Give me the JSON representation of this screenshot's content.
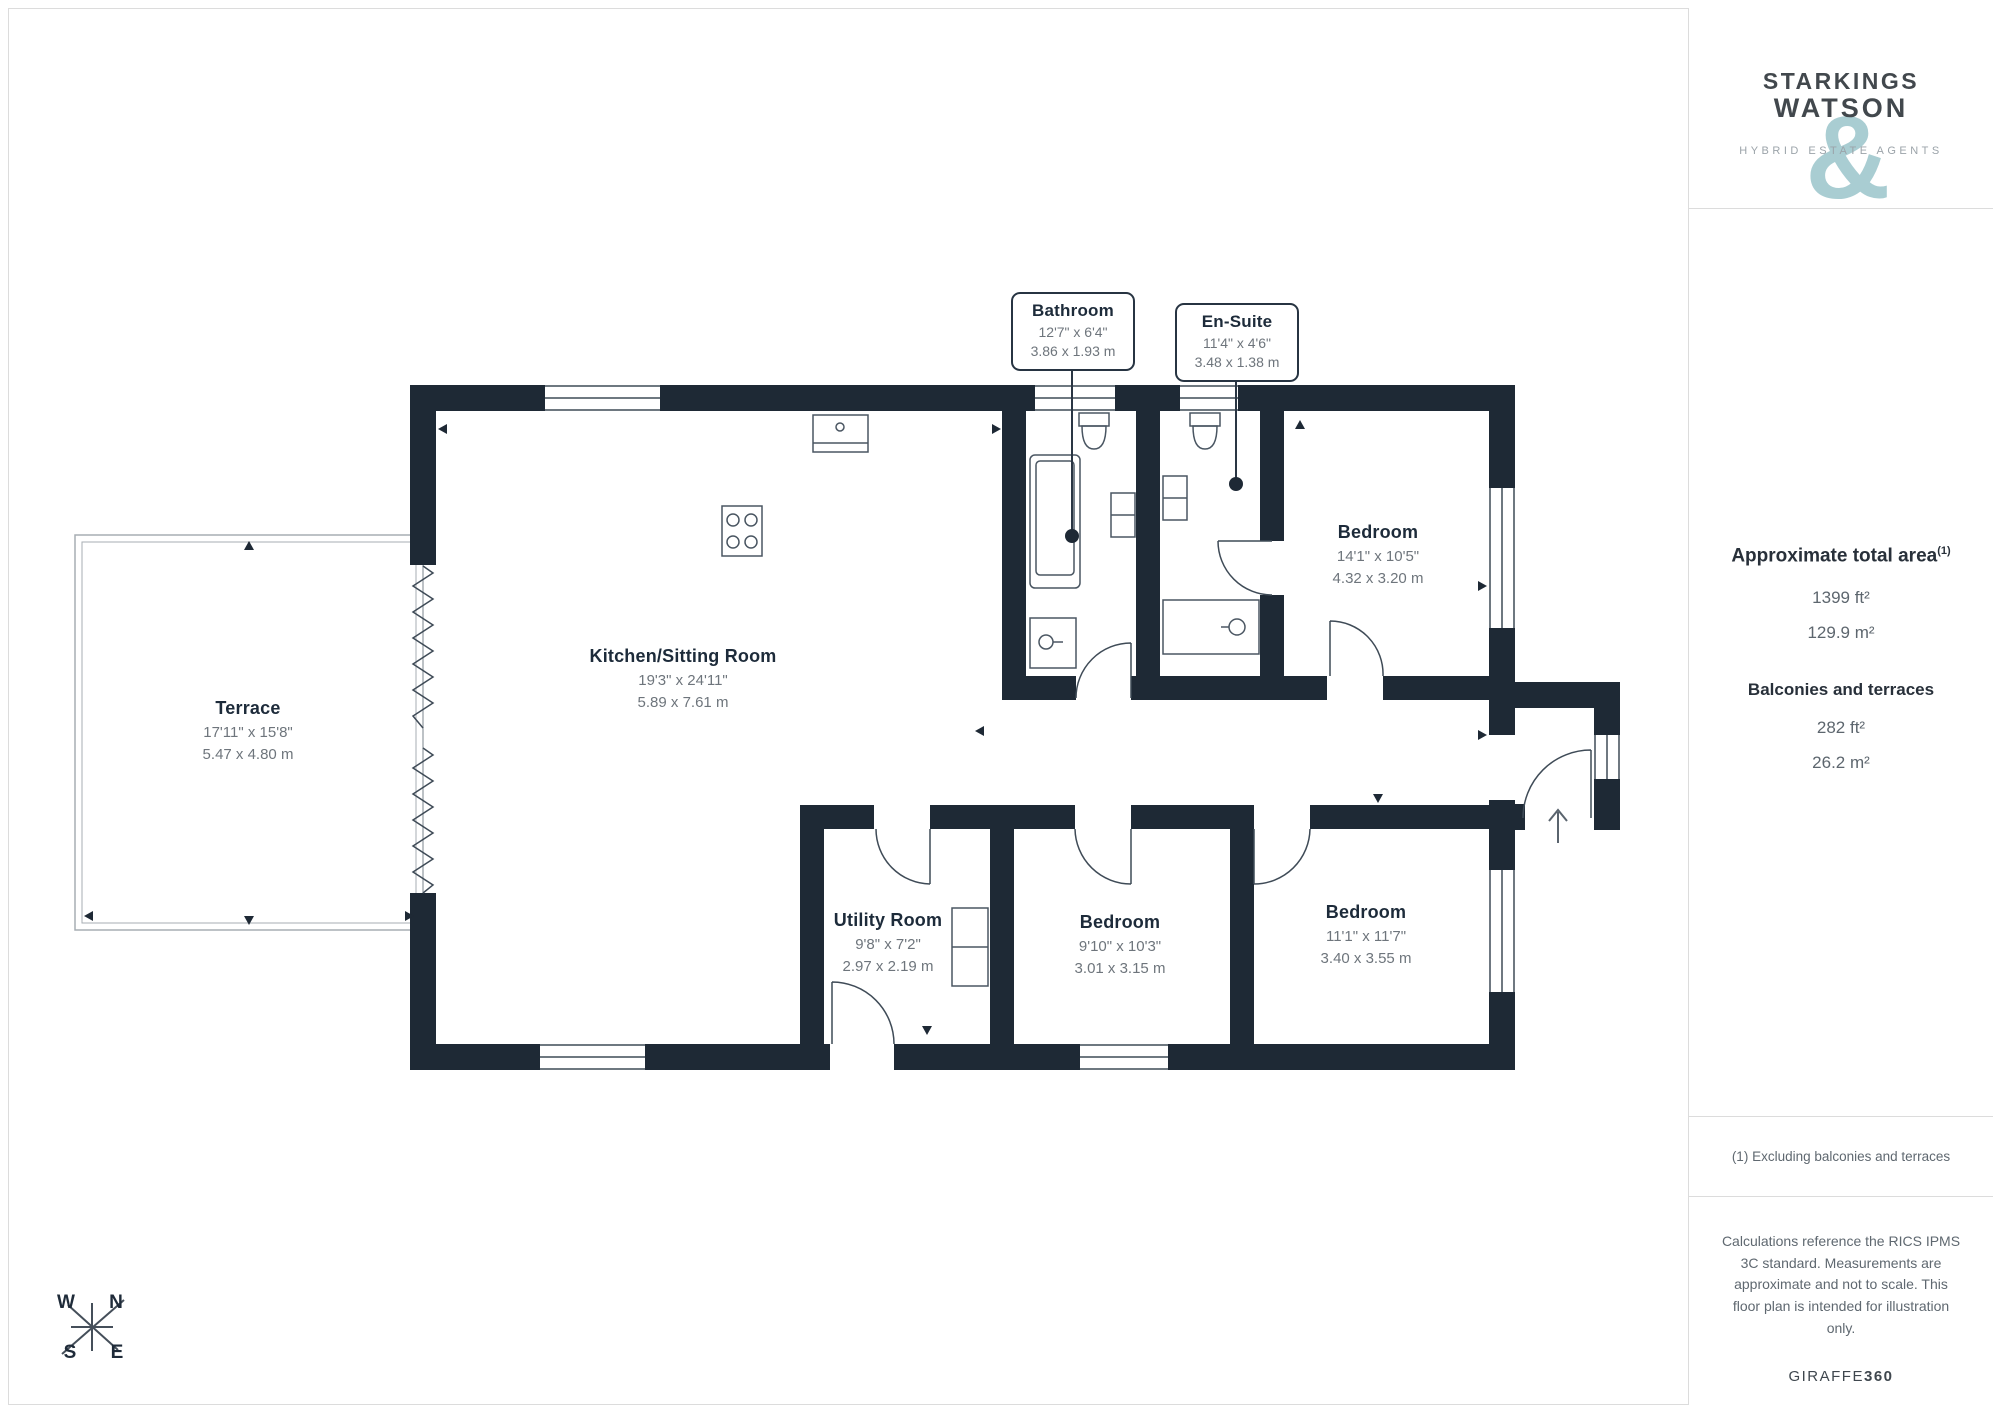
{
  "branding": {
    "name_line1": "STARKINGS",
    "name_line2": "WATSON",
    "ampersand": "&",
    "tagline": "HYBRID ESTATE AGENTS"
  },
  "sidebar": {
    "total_area_heading": "Approximate total area",
    "total_area_footnote": "(1)",
    "total_area_ft": "1399 ft²",
    "total_area_m": "129.9 m²",
    "balconies_heading": "Balconies and terraces",
    "balconies_ft": "282 ft²",
    "balconies_m": "26.2 m²",
    "footnote": "(1) Excluding balconies and terraces",
    "disclaimer": "Calculations reference the RICS IPMS 3C standard. Measurements are approximate and not to scale. This floor plan is intended for illustration only.",
    "brand_name": "GIRAFFE",
    "brand_number": "360"
  },
  "rooms": [
    {
      "name": "Terrace",
      "imperial": "17'11\" x 15'8\"",
      "metric": "5.47 x 4.80 m"
    },
    {
      "name": "Kitchen/Sitting Room",
      "imperial": "19'3\" x 24'11\"",
      "metric": "5.89 x 7.61 m"
    },
    {
      "name": "Bedroom",
      "imperial": "14'1\" x 10'5\"",
      "metric": "4.32 x 3.20 m"
    },
    {
      "name": "Utility Room",
      "imperial": "9'8\" x 7'2\"",
      "metric": "2.97 x 2.19 m"
    },
    {
      "name": "Bedroom",
      "imperial": "9'10\" x 10'3\"",
      "metric": "3.01 x 3.15 m"
    },
    {
      "name": "Bedroom",
      "imperial": "11'1\" x 11'7\"",
      "metric": "3.40 x 3.55 m"
    }
  ],
  "callouts": [
    {
      "name": "Bathroom",
      "imperial": "12'7\" x 6'4\"",
      "metric": "3.86 x 1.93 m"
    },
    {
      "name": "En-Suite",
      "imperial": "11'4\" x 4'6\"",
      "metric": "3.48 x 1.38 m"
    }
  ],
  "compass": {
    "n": "N",
    "e": "E",
    "s": "S",
    "w": "W"
  },
  "colors": {
    "wall": "#1e2935",
    "accent_teal": "#a9cdd2",
    "room_title": "#1d2b3a",
    "dim_text": "#6e757c"
  }
}
